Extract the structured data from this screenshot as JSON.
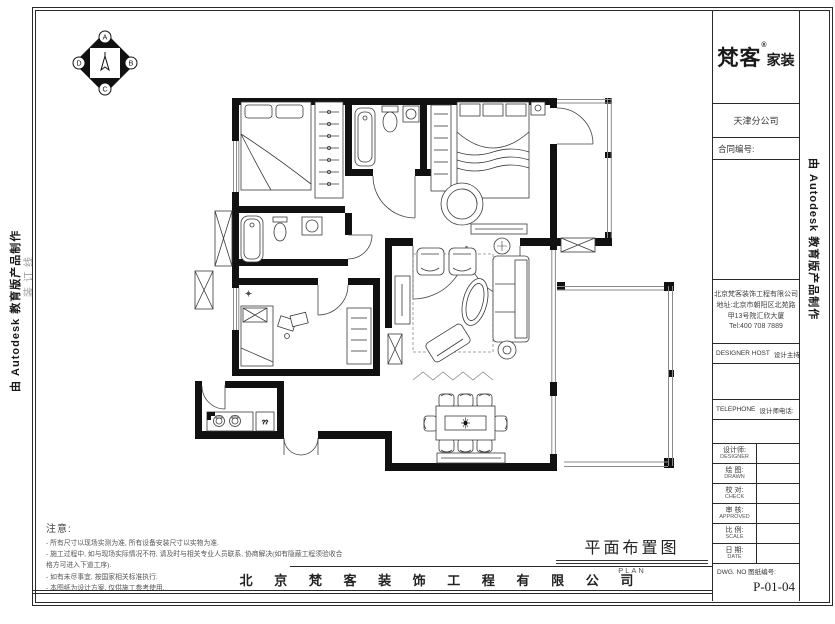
{
  "compass": {
    "letters": [
      "A",
      "B",
      "C",
      "D"
    ]
  },
  "brand": {
    "name": "梵客",
    "reg": "®",
    "suffix": "家装"
  },
  "titleblock": {
    "branch": "天津分公司",
    "client_label": "合同编号:",
    "company_info": {
      "line1": "北京梵客装饰工程有限公司",
      "line2": "地址:北京市朝阳区北苑路",
      "line3": "甲13号院汇欣大厦",
      "line4": "Tel:400 708 7889"
    },
    "designer_host_en": "DESIGNER HOST",
    "designer_host_cn": "设计主持人:",
    "telephone_en": "TELEPHONE",
    "telephone_cn": "设计师电话:",
    "rows": [
      {
        "cn": "设计师:",
        "en": "DESIGNER"
      },
      {
        "cn": "绘 图:",
        "en": "DRAWN"
      },
      {
        "cn": "校 对:",
        "en": "CHECK"
      },
      {
        "cn": "审 核:",
        "en": "APPROVED"
      },
      {
        "cn": "比 例:",
        "en": "SCALE"
      },
      {
        "cn": "日 期:",
        "en": "DATE"
      }
    ],
    "dwg_label_en": "DWG. NO",
    "dwg_label_cn": "图纸编号:",
    "dwg_no": "P-01-04"
  },
  "notes": {
    "title": "注意:",
    "items": [
      "- 所有尺寸以现场实测为准,  所有设备安装尺寸以实物为准.",
      "- 施工过程中, 如与现场实际情况不符, 请及时与相关专业人员联系, 协商解决(如有隐蔽工程须验收合格方可进入下道工序).",
      "- 如有未尽事宜, 按国家相关标准执行.",
      "- 本图纸为设计方案, 仅供施工参考使用."
    ]
  },
  "plan_title": {
    "cn": "平面布置图",
    "en": "PLAN"
  },
  "footer": {
    "company": "北 京 梵 客 装 饰 工 程 有 限 公 司"
  },
  "margins": {
    "autodesk": "由 Autodesk 教育版产品制作",
    "binding": "装订线"
  },
  "plan": {
    "box_label": "??"
  },
  "colors": {
    "line": "#1a1a1a",
    "wall": "#111111",
    "gray": "#9a9a9a"
  }
}
